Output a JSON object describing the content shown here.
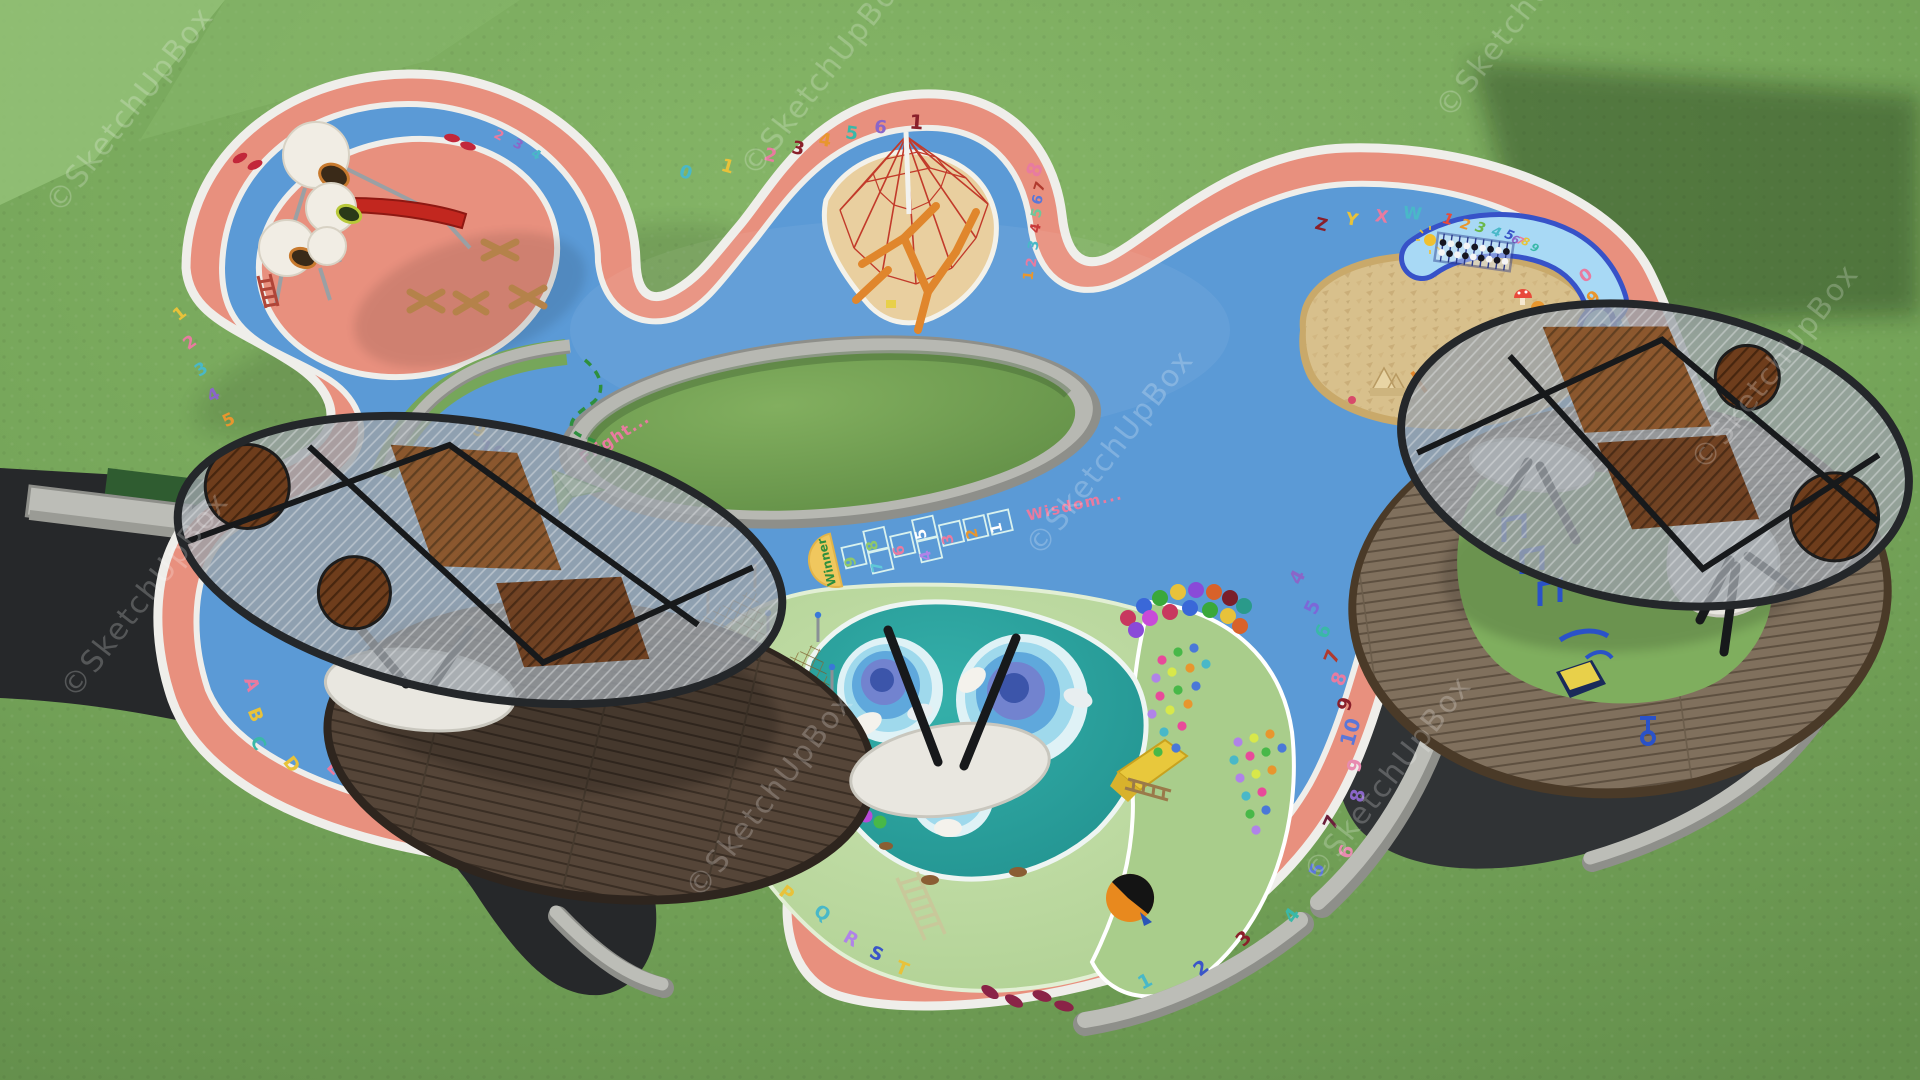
{
  "watermark": {
    "text": "©SketchUpBox"
  },
  "scene": {
    "subject": "aerial 3D render of a children's playground"
  },
  "hopscotch": {
    "start_label": "Winner",
    "end_label": "Wisdom...",
    "cells": [
      {
        "t": "9",
        "c": "#8fc86a",
        "col": 0,
        "row": "single"
      },
      {
        "t": "8",
        "c": "#8fc86a",
        "col": 1,
        "row": "top"
      },
      {
        "t": "7",
        "c": "#5fc8d8",
        "col": 1,
        "row": "bottom"
      },
      {
        "t": "6",
        "c": "#e87ba0",
        "col": 2,
        "row": "single"
      },
      {
        "t": "5",
        "c": "#ffffff",
        "col": 3,
        "row": "top"
      },
      {
        "t": "4",
        "c": "#b083e8",
        "col": 3,
        "row": "bottom"
      },
      {
        "t": "3",
        "c": "#e87ba0",
        "col": 4,
        "row": "single"
      },
      {
        "t": "2",
        "c": "#e8962e",
        "col": 5,
        "row": "single"
      },
      {
        "t": "1",
        "c": "#ffffff",
        "col": 6,
        "row": "single"
      }
    ]
  },
  "flight_label": "Flight...",
  "panel_numbers": [
    {
      "t": "1",
      "x": 1447,
      "y": 224,
      "r": 14,
      "c": "#e84a3a",
      "s": 15
    },
    {
      "t": "2",
      "x": 1464,
      "y": 229,
      "r": 16,
      "c": "#e8962e",
      "s": 14
    },
    {
      "t": "3",
      "x": 1479,
      "y": 232,
      "r": 18,
      "c": "#6ab84a",
      "s": 14
    },
    {
      "t": "4",
      "x": 1495,
      "y": 236,
      "r": 20,
      "c": "#49b8c8",
      "s": 13
    },
    {
      "t": "5",
      "x": 1508,
      "y": 239,
      "r": 22,
      "c": "#3a55c8",
      "s": 13
    },
    {
      "t": "6",
      "x": 1514,
      "y": 243,
      "r": 24,
      "c": "#8a66c8",
      "s": 11
    },
    {
      "t": "7",
      "x": 1519,
      "y": 244,
      "r": 24,
      "c": "#e87ba0",
      "s": 10
    },
    {
      "t": "8",
      "x": 1524,
      "y": 245,
      "r": 26,
      "c": "#e8c23a",
      "s": 11
    },
    {
      "t": "9",
      "x": 1533,
      "y": 251,
      "r": 28,
      "c": "#3ab8a8",
      "s": 11
    }
  ],
  "track_markings": [
    {
      "t": "1",
      "x": 183,
      "y": 318,
      "r": -38,
      "c": "#e8c23a",
      "s": 17
    },
    {
      "t": "2",
      "x": 193,
      "y": 347,
      "r": -35,
      "c": "#e87ba0",
      "s": 17
    },
    {
      "t": "3",
      "x": 204,
      "y": 374,
      "r": -32,
      "c": "#49b8c8",
      "s": 17
    },
    {
      "t": "4",
      "x": 216,
      "y": 400,
      "r": -28,
      "c": "#8a66c8",
      "s": 17
    },
    {
      "t": "5",
      "x": 231,
      "y": 425,
      "r": -25,
      "c": "#e8962e",
      "s": 17
    },
    {
      "t": "6",
      "x": 247,
      "y": 449,
      "r": -22,
      "c": "#3a55c8",
      "s": 17
    },
    {
      "t": "7",
      "x": 264,
      "y": 471,
      "r": -18,
      "c": "#e87ba0",
      "s": 17
    },
    {
      "t": "8",
      "x": 282,
      "y": 491,
      "r": -15,
      "c": "#8a1f2a",
      "s": 17
    },
    {
      "t": "9",
      "x": 477,
      "y": 436,
      "r": 22,
      "c": "#e8c23a",
      "s": 18
    },
    {
      "t": "10",
      "x": 489,
      "y": 457,
      "r": 24,
      "c": "#3a55c8",
      "s": 20
    },
    {
      "t": "2",
      "x": 497,
      "y": 139,
      "r": 28,
      "c": "#e87ba0",
      "s": 13
    },
    {
      "t": "3",
      "x": 516,
      "y": 148,
      "r": 30,
      "c": "#8a66c8",
      "s": 13
    },
    {
      "t": "4",
      "x": 534,
      "y": 158,
      "r": 32,
      "c": "#49b8c8",
      "s": 13
    },
    {
      "t": "0",
      "x": 684,
      "y": 178,
      "r": 18,
      "c": "#49b8c8",
      "s": 18
    },
    {
      "t": "1",
      "x": 726,
      "y": 172,
      "r": 16,
      "c": "#e8c23a",
      "s": 18
    },
    {
      "t": "2",
      "x": 769,
      "y": 161,
      "r": 14,
      "c": "#e87ba0",
      "s": 18
    },
    {
      "t": "3",
      "x": 797,
      "y": 154,
      "r": 12,
      "c": "#8a1f2a",
      "s": 18
    },
    {
      "t": "4",
      "x": 824,
      "y": 146,
      "r": 10,
      "c": "#e8962e",
      "s": 18
    },
    {
      "t": "5",
      "x": 851,
      "y": 139,
      "r": 8,
      "c": "#3ab8a8",
      "s": 18
    },
    {
      "t": "6",
      "x": 880,
      "y": 133,
      "r": 6,
      "c": "#8a66c8",
      "s": 18
    },
    {
      "t": "1",
      "x": 916,
      "y": 129,
      "r": 4,
      "c": "#8a1f2a",
      "s": 20
    },
    {
      "t": "8",
      "x": 1041,
      "y": 172,
      "r": -70,
      "c": "#e87ba0",
      "s": 20
    },
    {
      "t": "7",
      "x": 1044,
      "y": 188,
      "r": -72,
      "c": "#b03a2e",
      "s": 14
    },
    {
      "t": "6",
      "x": 1042,
      "y": 201,
      "r": -74,
      "c": "#5a77d8",
      "s": 14
    },
    {
      "t": "5",
      "x": 1041,
      "y": 214,
      "r": -76,
      "c": "#6ec89a",
      "s": 14
    },
    {
      "t": "4",
      "x": 1040,
      "y": 229,
      "r": -78,
      "c": "#c83a3a",
      "s": 14
    },
    {
      "t": "3",
      "x": 1038,
      "y": 246,
      "r": -80,
      "c": "#49b8c8",
      "s": 14
    },
    {
      "t": "2",
      "x": 1036,
      "y": 263,
      "r": -82,
      "c": "#e87ba0",
      "s": 14
    },
    {
      "t": "1",
      "x": 1033,
      "y": 276,
      "r": -84,
      "c": "#e8962e",
      "s": 14
    },
    {
      "t": "Z",
      "x": 1320,
      "y": 230,
      "r": 14,
      "c": "#8a1f2a",
      "s": 17
    },
    {
      "t": "Y",
      "x": 1351,
      "y": 225,
      "r": 10,
      "c": "#e8c23a",
      "s": 17
    },
    {
      "t": "X",
      "x": 1381,
      "y": 222,
      "r": 8,
      "c": "#e87ba0",
      "s": 17
    },
    {
      "t": "W",
      "x": 1412,
      "y": 219,
      "r": 6,
      "c": "#49b8c8",
      "s": 17
    },
    {
      "t": "0",
      "x": 1589,
      "y": 280,
      "r": -35,
      "c": "#e87ba0",
      "s": 17
    },
    {
      "t": "9",
      "x": 1597,
      "y": 302,
      "r": -40,
      "c": "#e8962e",
      "s": 17
    },
    {
      "t": "4",
      "x": 1303,
      "y": 580,
      "r": -62,
      "c": "#8a66c8",
      "s": 19
    },
    {
      "t": "5",
      "x": 1318,
      "y": 610,
      "r": -64,
      "c": "#7b68d8",
      "s": 19
    },
    {
      "t": "6",
      "x": 1329,
      "y": 634,
      "r": -66,
      "c": "#3ab8a8",
      "s": 19
    },
    {
      "t": "7",
      "x": 1338,
      "y": 659,
      "r": -68,
      "c": "#b03a2e",
      "s": 19
    },
    {
      "t": "8",
      "x": 1345,
      "y": 681,
      "r": -70,
      "c": "#e87ba0",
      "s": 19
    },
    {
      "t": "9",
      "x": 1351,
      "y": 706,
      "r": -72,
      "c": "#8a1f2a",
      "s": 19
    },
    {
      "t": "10",
      "x": 1357,
      "y": 734,
      "r": -74,
      "c": "#5a77d8",
      "s": 20
    },
    {
      "t": "9",
      "x": 1361,
      "y": 767,
      "r": -76,
      "c": "#e88bb0",
      "s": 19
    },
    {
      "t": "8",
      "x": 1364,
      "y": 797,
      "r": -78,
      "c": "#8a66c8",
      "s": 19
    },
    {
      "t": "7",
      "x": 1337,
      "y": 825,
      "r": -65,
      "c": "#6a1f3a",
      "s": 19
    },
    {
      "t": "6",
      "x": 1352,
      "y": 854,
      "r": -68,
      "c": "#e88bb0",
      "s": 19
    },
    {
      "t": "5",
      "x": 1323,
      "y": 872,
      "r": -70,
      "c": "#5a77d8",
      "s": 19
    },
    {
      "t": "4",
      "x": 1297,
      "y": 919,
      "r": -55,
      "c": "#3ab8a8",
      "s": 19
    },
    {
      "t": "3",
      "x": 1248,
      "y": 943,
      "r": -45,
      "c": "#8a1f2a",
      "s": 19
    },
    {
      "t": "2",
      "x": 1205,
      "y": 973,
      "r": -38,
      "c": "#3a55c8",
      "s": 19
    },
    {
      "t": "1",
      "x": 1148,
      "y": 987,
      "r": -28,
      "c": "#49b8c8",
      "s": 19
    },
    {
      "t": "O",
      "x": 746,
      "y": 862,
      "r": 42,
      "c": "#3a55c8",
      "s": 17
    },
    {
      "t": "P",
      "x": 783,
      "y": 898,
      "r": 38,
      "c": "#e8c23a",
      "s": 18
    },
    {
      "t": "Q",
      "x": 819,
      "y": 918,
      "r": 34,
      "c": "#49b8c8",
      "s": 18
    },
    {
      "t": "R",
      "x": 848,
      "y": 944,
      "r": 30,
      "c": "#b083e8",
      "s": 18
    },
    {
      "t": "S",
      "x": 874,
      "y": 959,
      "r": 26,
      "c": "#3a55c8",
      "s": 18
    },
    {
      "t": "T",
      "x": 900,
      "y": 974,
      "r": 22,
      "c": "#e8c23a",
      "s": 18
    },
    {
      "t": "2",
      "x": 716,
      "y": 834,
      "r": 46,
      "c": "#b083e8",
      "s": 17
    },
    {
      "t": "A",
      "x": 246,
      "y": 686,
      "r": 72,
      "c": "#e87ba0",
      "s": 18
    },
    {
      "t": "B",
      "x": 250,
      "y": 717,
      "r": 68,
      "c": "#e8c23a",
      "s": 18
    },
    {
      "t": "C",
      "x": 253,
      "y": 746,
      "r": 62,
      "c": "#3ab8a8",
      "s": 18
    },
    {
      "t": "D",
      "x": 287,
      "y": 768,
      "r": 52,
      "c": "#e8c23a",
      "s": 18
    },
    {
      "t": "E",
      "x": 330,
      "y": 772,
      "r": 44,
      "c": "#e87ba0",
      "s": 18
    },
    {
      "t": "F",
      "x": 361,
      "y": 790,
      "r": 38,
      "c": "#b083e8",
      "s": 18
    },
    {
      "t": "G",
      "x": 401,
      "y": 797,
      "r": 30,
      "c": "#e8962e",
      "s": 18
    },
    {
      "t": "H",
      "x": 441,
      "y": 781,
      "r": 22,
      "c": "#e87ba0",
      "s": 18
    },
    {
      "t": "I",
      "x": 480,
      "y": 778,
      "r": 16,
      "c": "#49b8c8",
      "s": 18
    },
    {
      "t": "J",
      "x": 524,
      "y": 783,
      "r": 12,
      "c": "#e8962e",
      "s": 18
    },
    {
      "t": "K",
      "x": 580,
      "y": 773,
      "r": 8,
      "c": "#e87ba0",
      "s": 18
    },
    {
      "t": "L",
      "x": 618,
      "y": 791,
      "r": 4,
      "c": "#49b8c8",
      "s": 18
    },
    {
      "t": "3",
      "x": 668,
      "y": 803,
      "r": 0,
      "c": "#e8c23a",
      "s": 18
    }
  ],
  "colors": {
    "grass": "#76a65a",
    "surface_blue": "#5b9ad6",
    "track_salmon": "#e8907e",
    "edge_white": "#efeeea",
    "pool_teal": "#2aa09c",
    "mound_green": "#bcd9a0",
    "sand": "#e9cf9f",
    "sandpit": "#d8c08c",
    "granite": "#b7b8b2",
    "asphalt": "#2b2e30",
    "panel_blue": "#a8d9f5",
    "panel_border": "#3752c8",
    "deck_dark": "#554538",
    "deck_light": "#7f6f5c",
    "canopy": "#9ba1a7",
    "net_red": "#c23a2a",
    "log_orange": "#e0862c",
    "slide_red": "#c2271f",
    "pod_white": "#f1ede4"
  }
}
